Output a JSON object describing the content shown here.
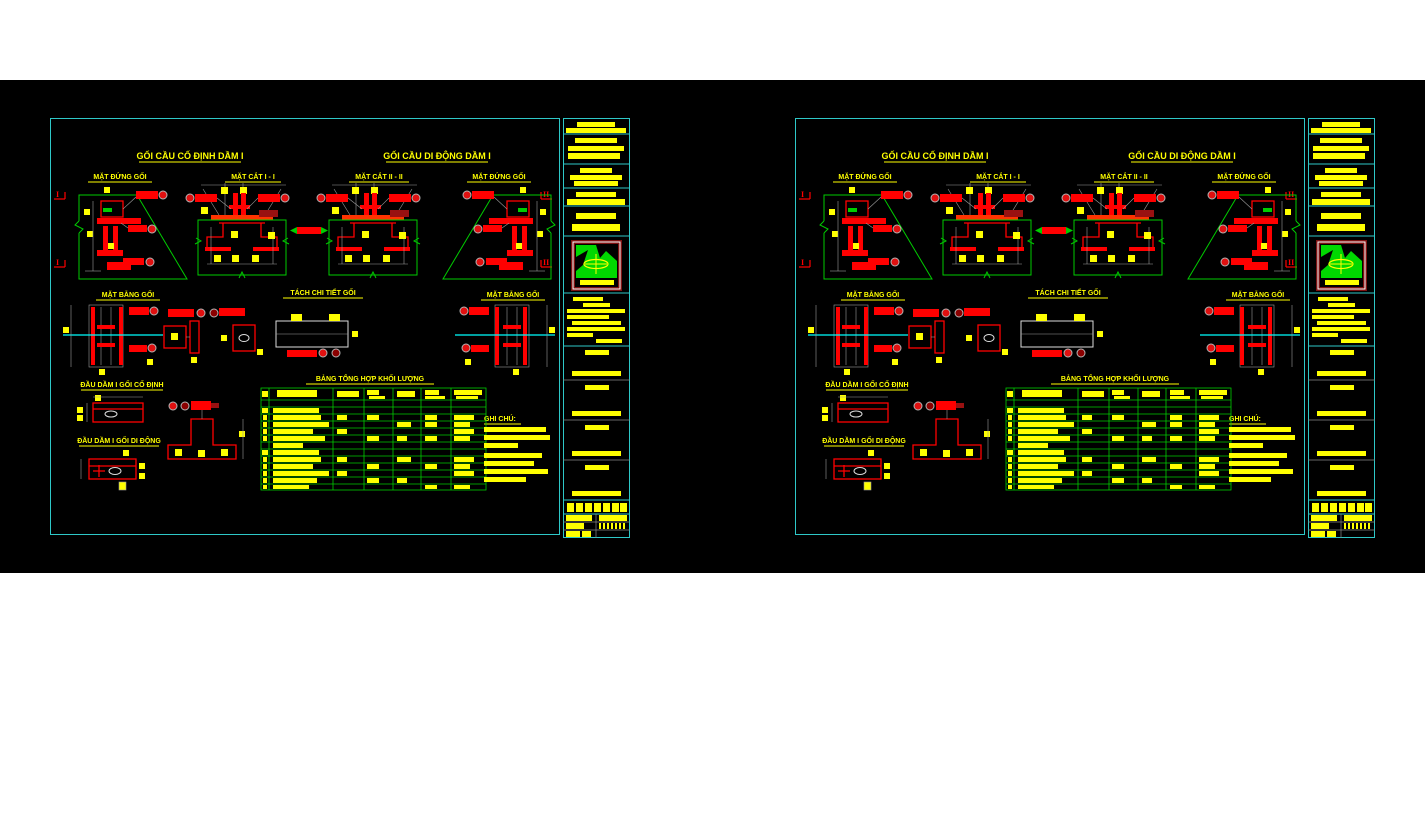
{
  "canvas": {
    "background": "#000000",
    "page_background": "#ffffff",
    "sheet_count": 2
  },
  "sheet": {
    "titles": {
      "fixed_bearing": "GỐI CẦU CỐ ĐỊNH DẦM I",
      "movable_bearing": "GỐI CẦU DI ĐỘNG DẦM I"
    },
    "view_labels": {
      "elevation_left": "MẶT ĐỨNG GỐI",
      "section_1": "MẶT CẮT I - I",
      "section_2": "MẶT CẮT II - II",
      "elevation_right": "MẶT ĐỨNG GỐI",
      "plan_left": "MẶT BẰNG GỐI",
      "detail": "TÁCH CHI TIẾT GỐI",
      "plan_right": "MẶT BẰNG GỐI",
      "beam_end_fixed": "ĐẦU DẦM I GỐI CỐ ĐỊNH",
      "beam_end_movable": "ĐẦU DẦM I GỐI DI ĐỘNG",
      "quantity_table": "BẢNG TỔNG HỢP KHỐI LƯỢNG",
      "notes": "GHI CHÚ:"
    },
    "sections": {
      "left": "I",
      "right": "II"
    },
    "colors": {
      "sheet_border": "#2ec8c8",
      "annotation_text": "#ffff00",
      "linework_red": "#ff0000",
      "linework_green": "#00cc00",
      "centerline_cyan": "#00ffff",
      "dimension_gray": "#9b9b9b",
      "logo_green": "#00d800",
      "logo_frame": "#7e1212"
    }
  }
}
